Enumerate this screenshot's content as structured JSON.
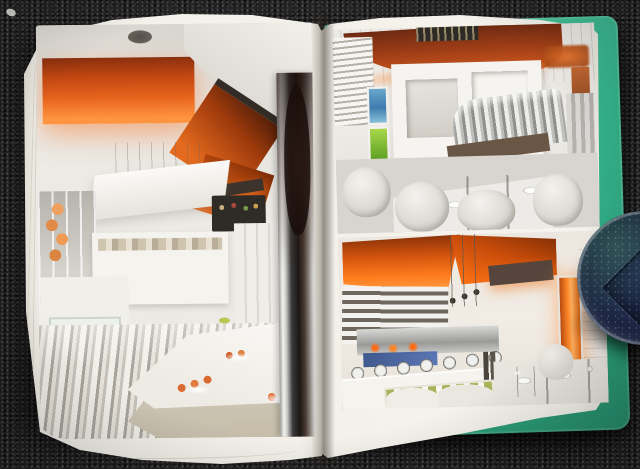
{
  "scene": {
    "type": "photograph",
    "description": "An open hardcover interior-design book lying on dark speckled carpet. The spread shows three photographs of a modern white restaurant interior accented with glowing orange light panels. A dark blue faceted glass paperweight rests at the book's right edge.",
    "carpet": {
      "base_color": "#242424",
      "speckle_color": "#8a8a8a"
    },
    "book": {
      "cover_color": "#35b58c",
      "page_color": "#f2f0e9",
      "pages": {
        "left": {
          "photo": "Buffet room with orange backlit ceiling panels, a mirror-polished column, grey striped floor, sushi on a curved white counter, glass case of stacked plates and citrus fruit"
        },
        "right_top": {
          "photo": "Dining room with rust-orange curved canopy, white display frames, blue and green nature art panels, ribbed chrome banquette and white molded chairs around set tables"
        },
        "right_bottom": {
          "photo": "Buffet line of silver chafing dishes with a row of green cups, angled orange light panels overhead and a glowing orange pillar"
        }
      }
    },
    "paperweight": {
      "shape": "dome",
      "glass_color": "#1d2748",
      "tint": "blue-green sparkle",
      "highlight_color": "#ffffff"
    }
  },
  "palette": {
    "accent_orange": "#e8651e",
    "deep_rust": "#9c3c16",
    "glow_orange": "#ff9440",
    "chrome_dark": "#1c1714",
    "paper_white": "#f2f0e9",
    "cover_green": "#35b58c",
    "art_blue": "#4a86b4",
    "art_green": "#6cb22e"
  }
}
